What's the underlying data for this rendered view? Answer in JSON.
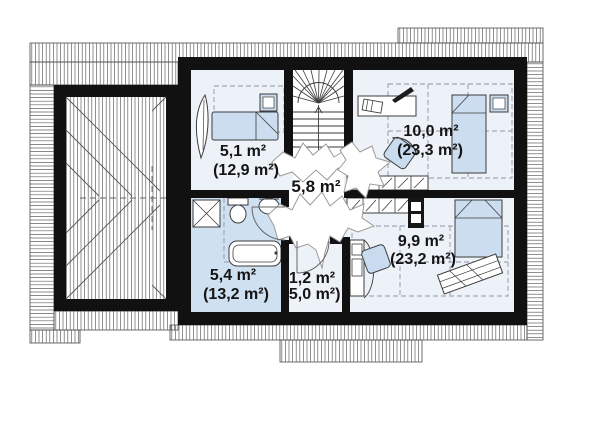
{
  "floor_plan": {
    "type": "attic-floor-plan",
    "rooms": [
      {
        "key": "bedroom-left",
        "area": "5,1 m²",
        "area_total": "(12,9 m²)"
      },
      {
        "key": "hallway",
        "area": "5,8 m²",
        "area_total": ""
      },
      {
        "key": "bedroom-top-right",
        "area": "10,0 m²",
        "area_total": "(23,3 m²)"
      },
      {
        "key": "bathroom",
        "area": "5,4 m²",
        "area_total": "(13,2 m²)"
      },
      {
        "key": "closet",
        "area": "1,2 m²",
        "area_total": "(5,0 m²)"
      },
      {
        "key": "bedroom-bottom-right",
        "area": "9,9 m²",
        "area_total": "(23,2 m²)"
      }
    ],
    "colors": {
      "wall": "#111111",
      "room_floor": "#edf2f8",
      "bathroom_floor": "#cfe0f1",
      "furniture_fill": "#c9dbee",
      "bed_fill": "#ccddf0",
      "hatch_line": "#616161",
      "outline": "#4a4a4a",
      "dashed_guide": "#8d97a8",
      "stair_line": "#3a3a3a",
      "burst_stroke": "#9a9a9a",
      "text": "#141414",
      "background": "#ffffff"
    }
  }
}
